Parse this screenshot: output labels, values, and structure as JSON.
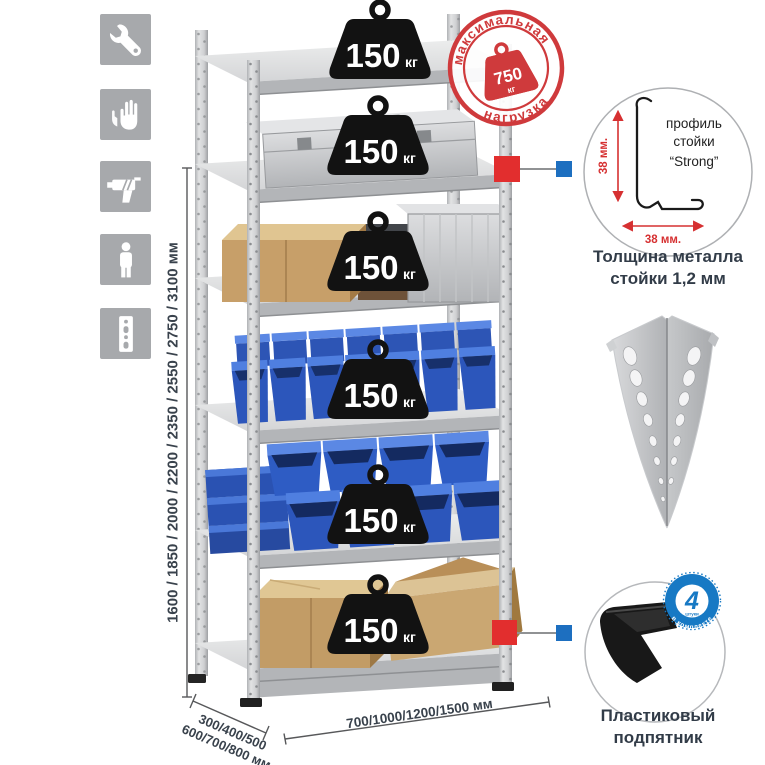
{
  "dims": {
    "height": "1600 / 1850 / 2000 / 2200 / 2350 / 2550 / 2750 / 3100 мм",
    "depth_line1": "300/400/500",
    "depth_line2": "600/700/800 мм",
    "width": "700/1000/1200/1500 мм"
  },
  "shelf_load": {
    "value": "150",
    "unit": "кг"
  },
  "stamp": {
    "arc_top": "максимальная",
    "arc_bottom": "нагрузка",
    "value": "750",
    "unit": "кг"
  },
  "profile": {
    "dim_v": "38 мм.",
    "dim_h": "38 мм.",
    "label1": "профиль",
    "label2": "стойки",
    "label3": "“Strong”",
    "caption1": "Толщина металла",
    "caption2": "стойки 1,2 мм"
  },
  "foot": {
    "qty": "4",
    "qty_sub": "штуки",
    "arc": "в комплекте",
    "caption1": "Пластиковый",
    "caption2": "подпятник"
  },
  "icon_names": [
    "wrench",
    "gloves",
    "drill",
    "person",
    "perforated-post"
  ],
  "colors": {
    "stamp_red": "#cf3a3c",
    "marker_red": "#e22e2e",
    "marker_blue": "#1d6fc0",
    "bin_blue": "#2c56bb",
    "badge_black": "#121212",
    "dim_text": "#39424c",
    "icon_gray": "#a7a9ac"
  }
}
